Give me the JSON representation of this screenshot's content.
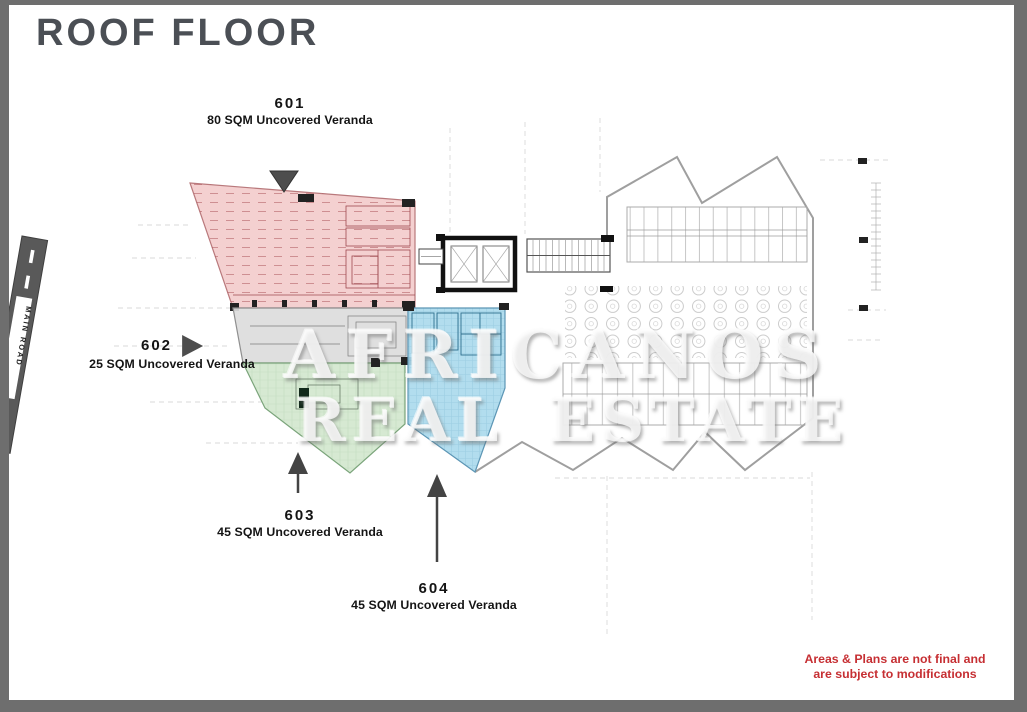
{
  "page": {
    "title": "ROOF FLOOR"
  },
  "units": [
    {
      "number": "601",
      "area_label": "80 SQM Uncovered Veranda",
      "color": "#f3caca"
    },
    {
      "number": "602",
      "area_label": "25 SQM Uncovered Veranda",
      "color": "#dcdcdc"
    },
    {
      "number": "603",
      "area_label": "45 SQM Uncovered Veranda",
      "color": "#d2e7cd"
    },
    {
      "number": "604",
      "area_label": "45 SQM Uncovered Veranda",
      "color": "#abdaed"
    }
  ],
  "road": {
    "label": "MAIN ROAD"
  },
  "watermark": {
    "line1": "AFRICANOS",
    "line2": "REAL ESTATE"
  },
  "disclaimer": {
    "line1": "Areas & Plans are not final and",
    "line2": "are subject to modifications",
    "color": "#c62f33"
  },
  "frame_color": "#6e6e6e",
  "title_color": "#4b4f55"
}
